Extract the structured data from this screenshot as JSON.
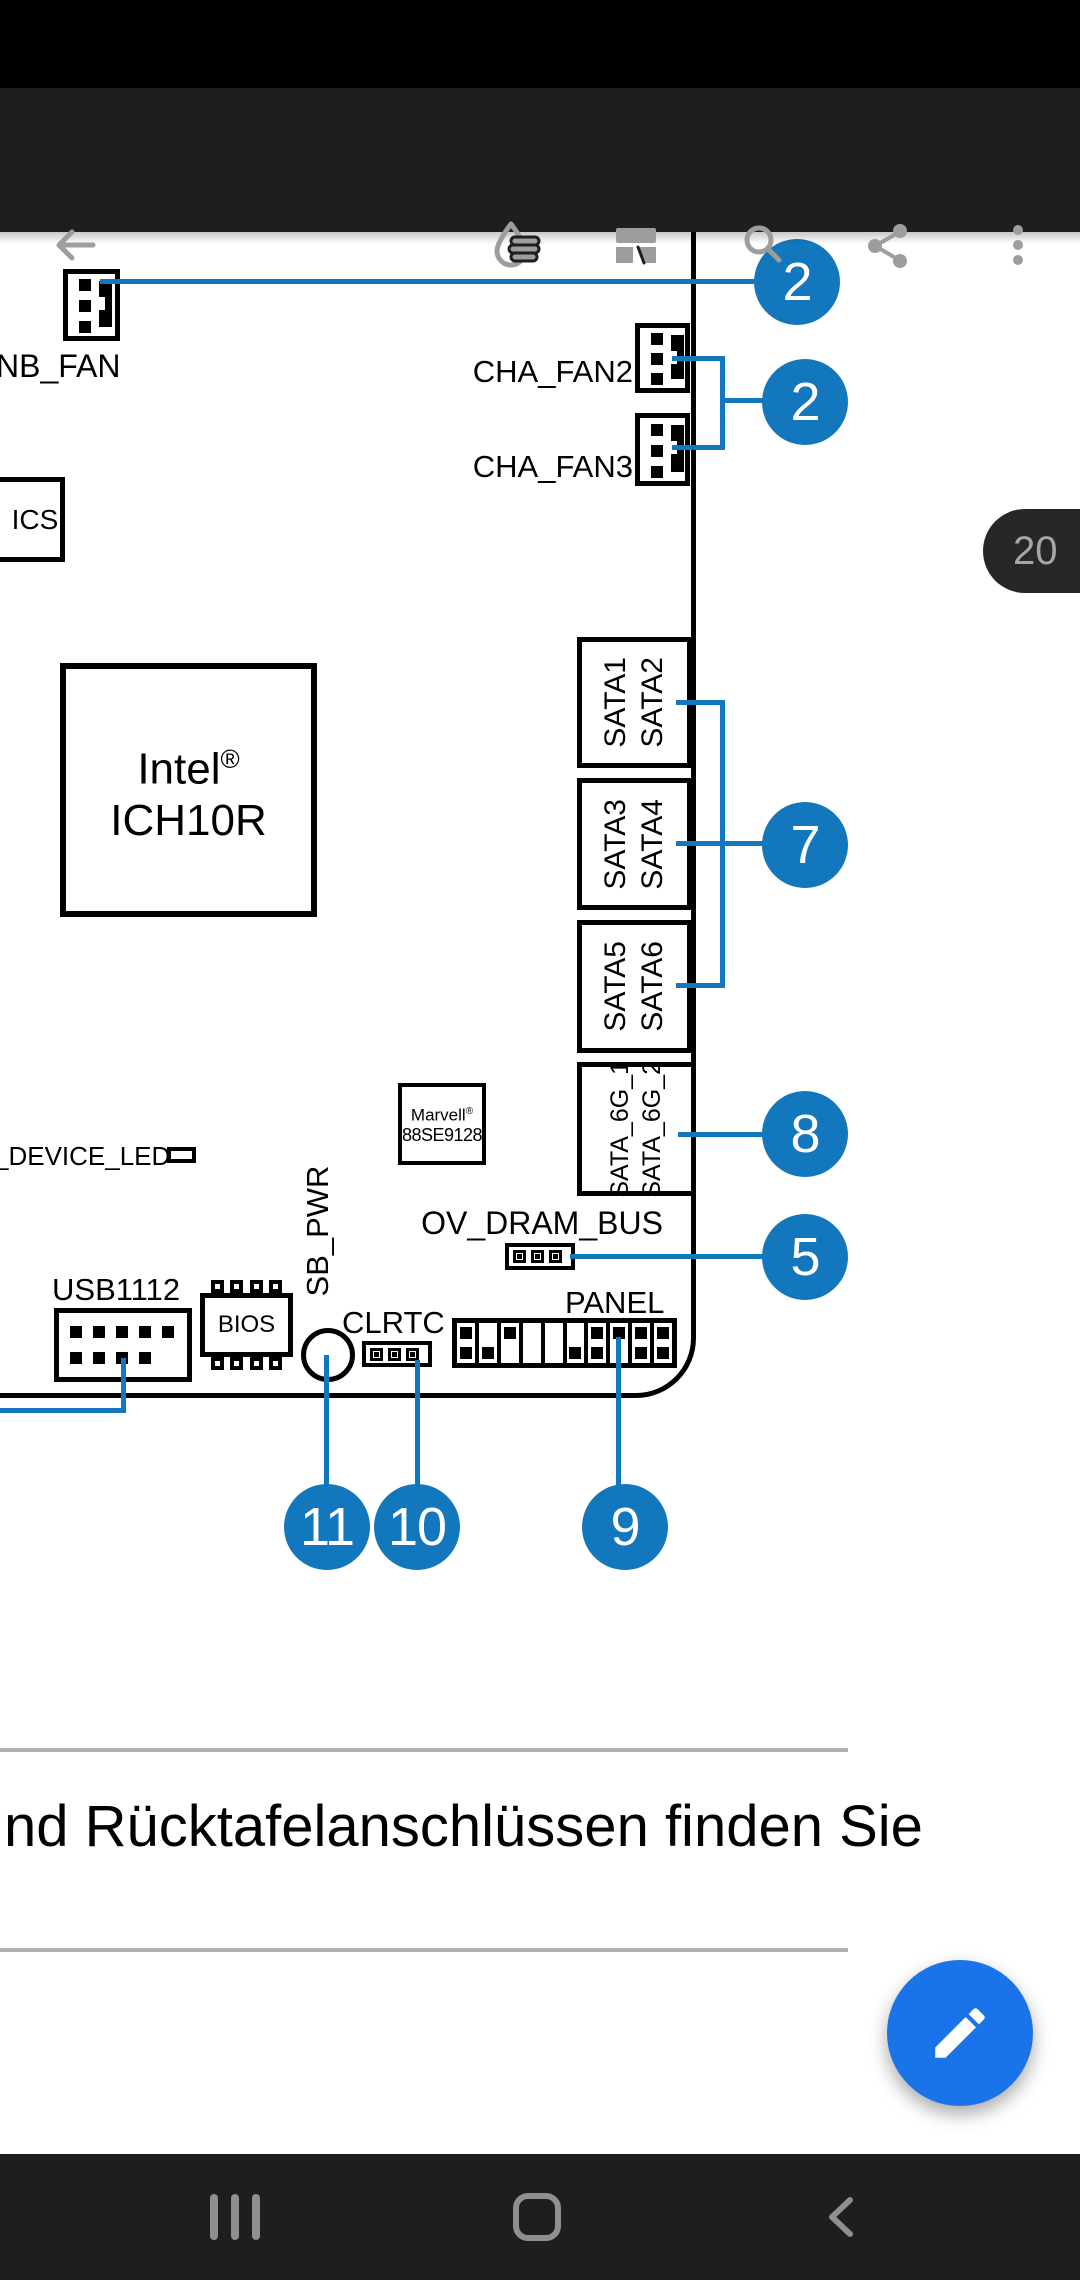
{
  "app_bar": {
    "icons": [
      "back-arrow",
      "ink-annotate",
      "page-layout",
      "search",
      "share",
      "overflow-menu"
    ]
  },
  "page_badge": {
    "page_number": "20"
  },
  "diagram": {
    "labels": {
      "nb_fan": "NB_FAN",
      "cha_fan2": "CHA_FAN2",
      "cha_fan3": "CHA_FAN3",
      "ics": "ICS",
      "device_led": "_DEVICE_LED",
      "ov_dram_bus": "OV_DRAM_BUS",
      "usb1112": "USB1112",
      "bios": "BIOS",
      "sb_pwr": "SB_PWR",
      "clrtc": "CLRTC",
      "panel": "PANEL"
    },
    "intel_chip": {
      "name": "Intel",
      "reg": "®",
      "model": "ICH10R"
    },
    "marvell_chip": {
      "name": "Marvell",
      "reg": "®",
      "model": "88SE9128"
    },
    "sata": [
      {
        "a": "SATA1",
        "b": "SATA2"
      },
      {
        "a": "SATA3",
        "b": "SATA4"
      },
      {
        "a": "SATA5",
        "b": "SATA6"
      },
      {
        "a": "SATA_6G_1",
        "b": "SATA_6G_2"
      }
    ],
    "callouts": {
      "nb_fan": "2",
      "cha_fans": "2",
      "sata": "7",
      "sata_6g": "8",
      "ov_dram_bus": "5",
      "sb_pwr": "11",
      "clrtc": "10",
      "panel": "9"
    },
    "panel_pins": [
      "tb",
      "b",
      "t",
      "",
      "",
      "b",
      "tb",
      "t",
      "tb",
      "tb"
    ],
    "usb_pin_rows": [
      5,
      4
    ],
    "bios_pin_count": 4,
    "colors": {
      "callout_blue": "#1377bd",
      "fab_blue": "#1a73e8"
    }
  },
  "body_text": "nd Rücktafelanschlüssen finden Sie"
}
